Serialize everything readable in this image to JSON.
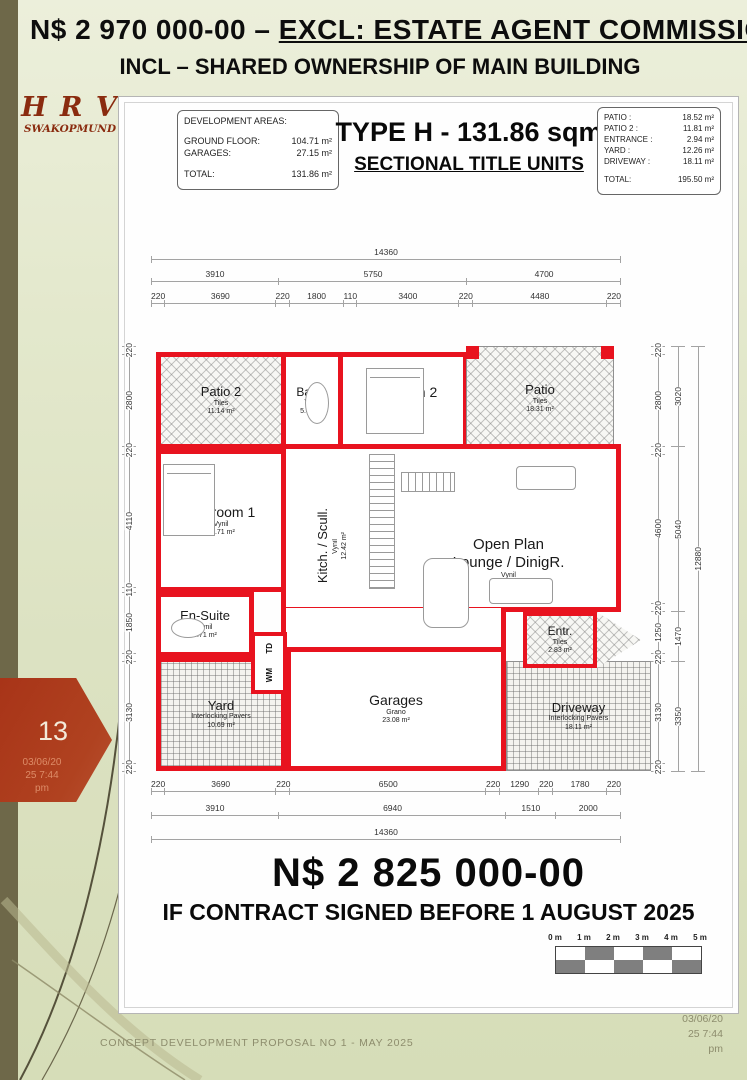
{
  "colors": {
    "wall_red": "#e8131f",
    "page_bg": "#dce2c2",
    "olive_bar": "#6e6849",
    "badge_red": "#ac3a1d",
    "logo_red": "#8a2b0f"
  },
  "header": {
    "price_part": "N$ 2 970 000-00",
    "separator": " – ",
    "underlined_part": "EXCL: ESTATE AGENT COMMISSION",
    "line2": "INCL – SHARED OWNERSHIP OF MAIN BUILDING"
  },
  "logo": {
    "name": "H R V",
    "sub": "SWAKOPMUND"
  },
  "page_badge": {
    "number": "13",
    "date_lines": [
      "03/06/20",
      "25 7:44",
      "pm"
    ]
  },
  "sheet": {
    "dev_areas": {
      "title": "DEVELOPMENT AREAS:",
      "rows": [
        {
          "label": "GROUND FLOOR:",
          "value": "104.71 m²"
        },
        {
          "label": "GARAGES:",
          "value": "27.15 m²"
        }
      ],
      "total": {
        "label": "TOTAL:",
        "value": "131.86 m²"
      }
    },
    "title": "TYPE H - 131.86 sqm",
    "subtitle": "SECTIONAL TITLE UNITS",
    "site_areas": {
      "rows": [
        {
          "label": "PATIO :",
          "value": "18.52 m²"
        },
        {
          "label": "PATIO 2 :",
          "value": "11.81 m²"
        },
        {
          "label": "ENTRANCE :",
          "value": "2.94 m²"
        },
        {
          "label": "YARD :",
          "value": "12.26 m²"
        },
        {
          "label": "DRIVEWAY :",
          "value": "18.11 m²"
        }
      ],
      "total": {
        "label": "TOTAL:",
        "value": "195.50 m²"
      }
    },
    "price": "N$ 2 825 000-00",
    "condition": "IF CONTRACT SIGNED BEFORE 1 AUGUST 2025",
    "scalebar": {
      "labels": [
        "0 m",
        "1 m",
        "2 m",
        "3 m",
        "4 m",
        "5 m"
      ]
    }
  },
  "plan": {
    "dims": {
      "top_total": [
        14360
      ],
      "top_mid": [
        3910,
        5750,
        4700
      ],
      "top_detail": [
        220,
        3690,
        220,
        1800,
        110,
        3400,
        220,
        4480,
        220
      ],
      "bottom_detail": [
        220,
        3690,
        220,
        6500,
        220,
        1290,
        220,
        1780,
        220
      ],
      "bottom_mid": [
        3910,
        6940,
        1510,
        2000
      ],
      "bottom_total": [
        14360
      ],
      "left": [
        220,
        2800,
        220,
        4110,
        110,
        1850,
        220,
        3130,
        220
      ],
      "right_inner": [
        220,
        2800,
        220,
        4600,
        220,
        1250,
        220,
        3130,
        220
      ],
      "right_mid": [
        3020,
        5040,
        1470,
        3350
      ],
      "right_total": [
        12880
      ]
    },
    "rooms": {
      "patio2": {
        "name": "Patio 2",
        "material": "Tiles",
        "area": "11.14 m²"
      },
      "bath": {
        "name": "Bathr.",
        "material": "Vynil",
        "area": "5.42 m²"
      },
      "bedroom2": {
        "name": "Bedroom 2",
        "material": "Vynil",
        "area": "14.35 m²"
      },
      "patio": {
        "name": "Patio",
        "material": "Tiles",
        "area": "18.31 m²"
      },
      "bedroom1": {
        "name": "Bedroom 1",
        "material": "Vynil",
        "area": "15.71 m²"
      },
      "kitchen": {
        "name": "Kitch. / Scull.",
        "material": "Vynil",
        "area": "12.42 m²"
      },
      "lounge": {
        "name": "Open Plan",
        "name2": "Lounge / DinigR.",
        "material": "Vynil",
        "area": "38.70 m²"
      },
      "ensuite": {
        "name": "En-Suite",
        "material": "Vynil",
        "area": "5.71 m²"
      },
      "entr": {
        "name": "Entr.",
        "material": "Tiles",
        "area": "2.83 m²"
      },
      "yard": {
        "name": "Yard",
        "material": "Interlocking Pavers",
        "area": "10.69 m²"
      },
      "garages": {
        "name": "Garages",
        "material": "Grano",
        "area": "23.08 m²"
      },
      "driveway": {
        "name": "Driveway",
        "material": "Interlocking Pavers",
        "area": "18.11 m²"
      },
      "wm": "WM",
      "td": "TD"
    }
  },
  "footer": {
    "text": "CONCEPT DEVELOPMENT PROPOSAL NO 1 - MAY 2025",
    "date_lines": [
      "03/06/20",
      "25 7:44",
      "pm"
    ]
  }
}
